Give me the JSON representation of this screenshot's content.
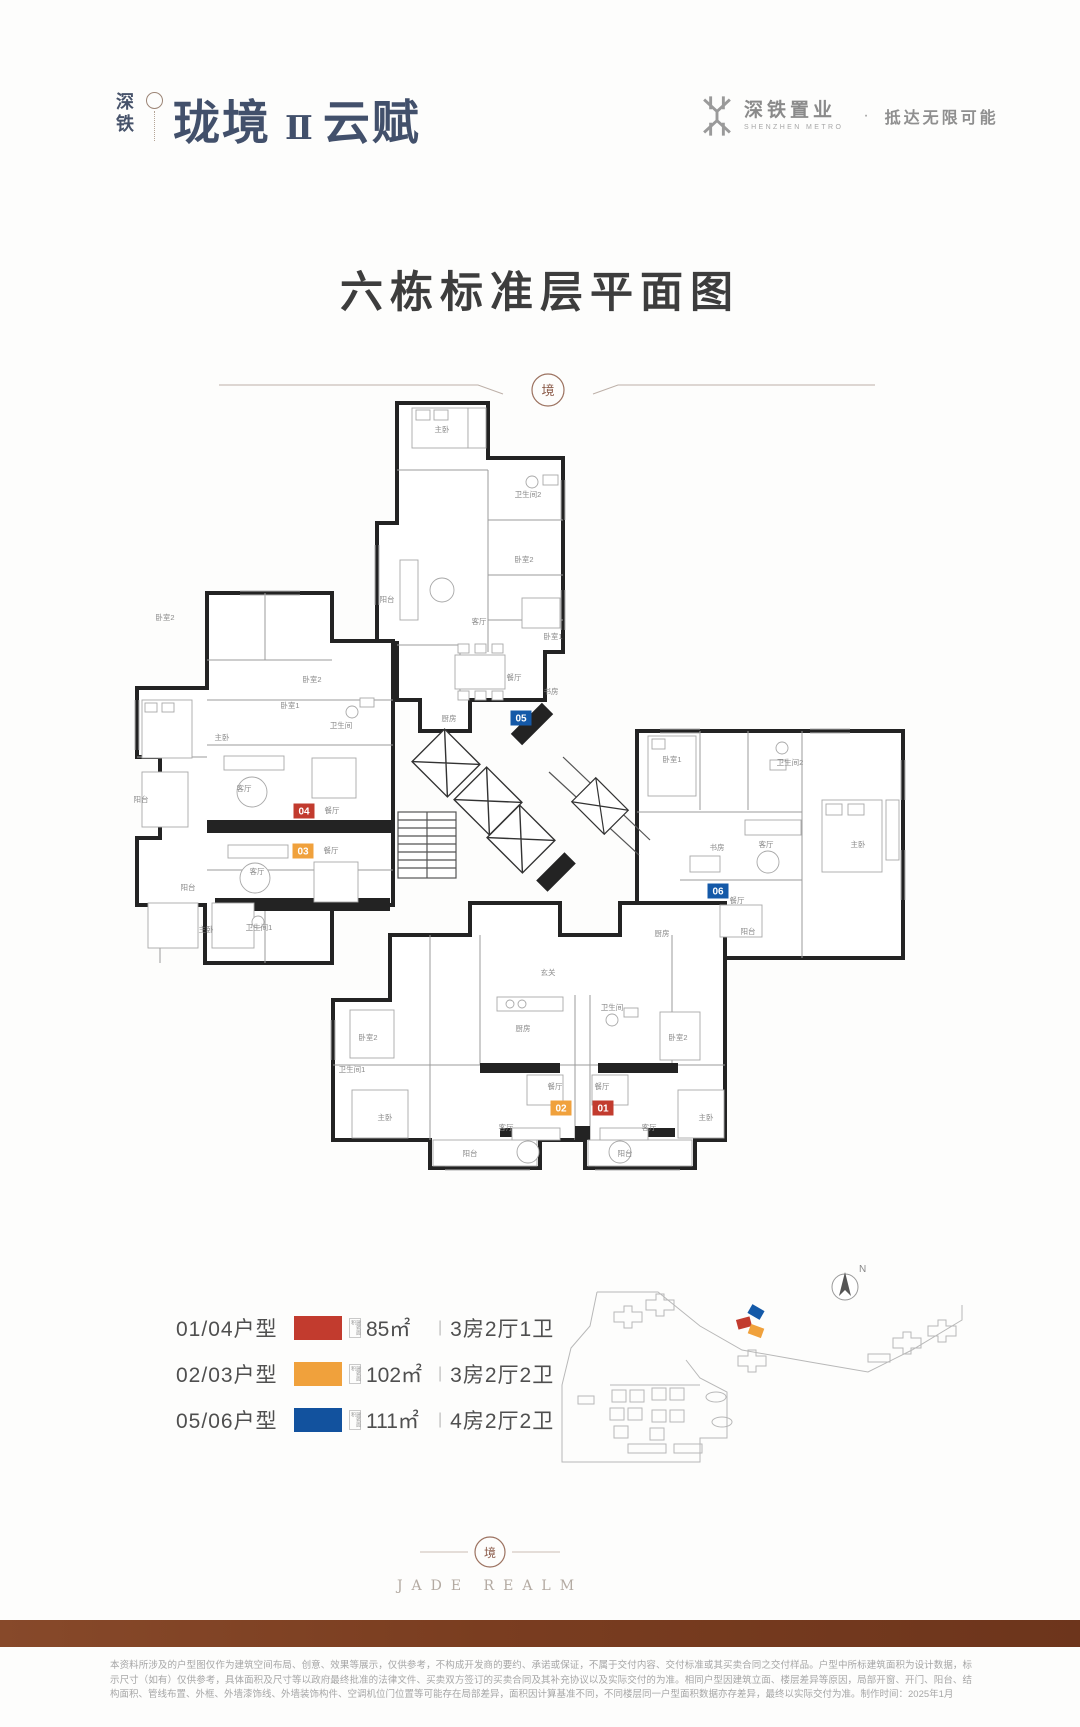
{
  "header": {
    "logo": {
      "vertical_text": "深铁",
      "main_text": "珑境",
      "numeral": "Ⅱ",
      "suffix_text": "云赋"
    },
    "brand": {
      "name": "深铁置业",
      "name_en": "SHENZHEN METRO",
      "separator": "·",
      "tagline": "抵达无限可能"
    }
  },
  "title": "六栋标准层平面图",
  "divider": {
    "seal_char": "境"
  },
  "floorplan": {
    "unit_badges": [
      {
        "id": "05",
        "x": 521,
        "y": 718,
        "color": "#1459a8"
      },
      {
        "id": "04",
        "x": 304,
        "y": 811,
        "color": "#c23b2e"
      },
      {
        "id": "03",
        "x": 303,
        "y": 851,
        "color": "#f0a13c"
      },
      {
        "id": "06",
        "x": 718,
        "y": 891,
        "color": "#1459a8"
      },
      {
        "id": "02",
        "x": 561,
        "y": 1108,
        "color": "#f0a13c"
      },
      {
        "id": "01",
        "x": 603,
        "y": 1108,
        "color": "#c23b2e"
      }
    ],
    "room_labels": [
      {
        "t": "主卧",
        "x": 442,
        "y": 432
      },
      {
        "t": "卫生间2",
        "x": 528,
        "y": 497
      },
      {
        "t": "卧室2",
        "x": 524,
        "y": 562
      },
      {
        "t": "阳台",
        "x": 387,
        "y": 602
      },
      {
        "t": "客厅",
        "x": 479,
        "y": 624
      },
      {
        "t": "卧室1",
        "x": 553,
        "y": 639
      },
      {
        "t": "餐厅",
        "x": 514,
        "y": 680
      },
      {
        "t": "书房",
        "x": 551,
        "y": 694
      },
      {
        "t": "厨房",
        "x": 449,
        "y": 721
      },
      {
        "t": "卧室2",
        "x": 312,
        "y": 682
      },
      {
        "t": "卧室1",
        "x": 290,
        "y": 708
      },
      {
        "t": "卫生间",
        "x": 341,
        "y": 728
      },
      {
        "t": "主卧",
        "x": 222,
        "y": 740
      },
      {
        "t": "客厅",
        "x": 244,
        "y": 791
      },
      {
        "t": "餐厅",
        "x": 332,
        "y": 813
      },
      {
        "t": "餐厅",
        "x": 331,
        "y": 853
      },
      {
        "t": "客厅",
        "x": 257,
        "y": 874
      },
      {
        "t": "阳台",
        "x": 141,
        "y": 802
      },
      {
        "t": "阳台",
        "x": 188,
        "y": 890
      },
      {
        "t": "卧室2",
        "x": 165,
        "y": 620
      },
      {
        "t": "主卧",
        "x": 206,
        "y": 932
      },
      {
        "t": "卫生间1",
        "x": 259,
        "y": 930
      },
      {
        "t": "卧室1",
        "x": 672,
        "y": 762
      },
      {
        "t": "卫生间2",
        "x": 790,
        "y": 765
      },
      {
        "t": "书房",
        "x": 717,
        "y": 850
      },
      {
        "t": "客厅",
        "x": 766,
        "y": 847
      },
      {
        "t": "餐厅",
        "x": 737,
        "y": 903
      },
      {
        "t": "主卧",
        "x": 858,
        "y": 847
      },
      {
        "t": "阳台",
        "x": 748,
        "y": 934
      },
      {
        "t": "厨房",
        "x": 662,
        "y": 936
      },
      {
        "t": "玄关",
        "x": 548,
        "y": 975
      },
      {
        "t": "厨房",
        "x": 523,
        "y": 1031
      },
      {
        "t": "卫生间",
        "x": 612,
        "y": 1010
      },
      {
        "t": "卧室2",
        "x": 368,
        "y": 1040
      },
      {
        "t": "卧室2",
        "x": 678,
        "y": 1040
      },
      {
        "t": "卫生间1",
        "x": 352,
        "y": 1072
      },
      {
        "t": "餐厅",
        "x": 555,
        "y": 1089
      },
      {
        "t": "餐厅",
        "x": 602,
        "y": 1089
      },
      {
        "t": "客厅",
        "x": 506,
        "y": 1130
      },
      {
        "t": "客厅",
        "x": 649,
        "y": 1130
      },
      {
        "t": "主卧",
        "x": 385,
        "y": 1120
      },
      {
        "t": "主卧",
        "x": 706,
        "y": 1120
      },
      {
        "t": "阳台",
        "x": 470,
        "y": 1156
      },
      {
        "t": "阳台",
        "x": 625,
        "y": 1156
      }
    ]
  },
  "legend": {
    "rows": [
      {
        "units": "01/04户型",
        "color": "#c23b2e",
        "area_note": "建筑面积",
        "area": "85㎡",
        "divider": "|",
        "layout": "3房2厅1卫"
      },
      {
        "units": "02/03户型",
        "color": "#f0a13c",
        "area_note": "建筑面积",
        "area": "102㎡",
        "divider": "|",
        "layout": "3房2厅2卫"
      },
      {
        "units": "05/06户型",
        "color": "#12529e",
        "area_note": "建筑面积",
        "area": "111㎡",
        "divider": "|",
        "layout": "4房2厅2卫"
      }
    ]
  },
  "siteplan": {
    "compass_label": "N",
    "highlights": [
      {
        "color": "#1459a8",
        "x": 756,
        "y": 1312,
        "rot": 30
      },
      {
        "color": "#c23b2e",
        "x": 744,
        "y": 1323,
        "rot": -15
      },
      {
        "color": "#f0a13c",
        "x": 756,
        "y": 1331,
        "rot": 20
      }
    ]
  },
  "footer": {
    "seal_char": "境",
    "brand_en": "JADE REALM",
    "disclaimer": "本资料所涉及的户型图仅作为建筑空间布局、创意、效果等展示，仅供参考，不构成开发商的要约、承诺或保证，不属于交付内容、交付标准或其买卖合同之交付样品。户型中所标建筑面积为设计数据，标示尺寸（如有）仅供参考，具体面积及尺寸等以政府最终批准的法律文件、买卖双方签订的买卖合同及其补充协议以及实际交付的为准。相同户型因建筑立面、楼层差异等原因，局部开窗、开门、阳台、结构面积、管线布置、外框、外墙漆饰线、外墙装饰构件、空调机位门位置等可能存在局部差异，面积因计算基准不同，不同楼层同一户型面积数据亦存差异，最终以实际交付为准。制作时间：2025年1月"
  }
}
